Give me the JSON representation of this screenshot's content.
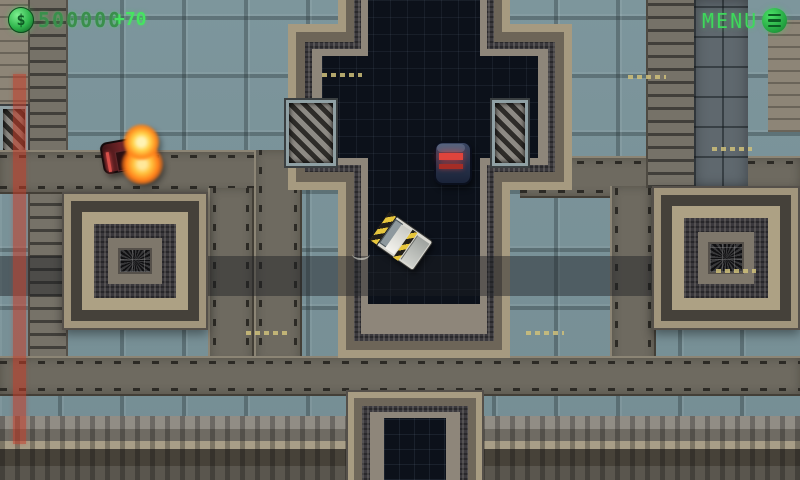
{
  "hud": {
    "money": {
      "currency_symbol": "$",
      "value": "500000",
      "delta": "+70",
      "icon": "dollar-coin-icon"
    },
    "menu": {
      "label": "MENU",
      "icon": "menu-hamburger-icon"
    },
    "damage_bar": {
      "position": "left-edge",
      "orientation": "vertical",
      "color": "#c43c2c"
    }
  },
  "colors": {
    "hud_green_bright": "#46e361",
    "hud_green_text": "#3a8f4c",
    "damage_red": "#c43c2c",
    "ground_teal": "#7e989f",
    "structure_navy": "#0c111a",
    "structure_tan": "#a69a80",
    "flame_orange": "#ff8c1e"
  },
  "scene": {
    "entities": [
      {
        "name": "enemy-car-burning",
        "state": "on-fire"
      },
      {
        "name": "enemy-car-dark",
        "state": "driving"
      },
      {
        "name": "player-truck",
        "state": "idle"
      }
    ],
    "structures": [
      "cross-building-top",
      "vent-structure-left",
      "vent-structure-right",
      "cross-building-bottom"
    ]
  }
}
